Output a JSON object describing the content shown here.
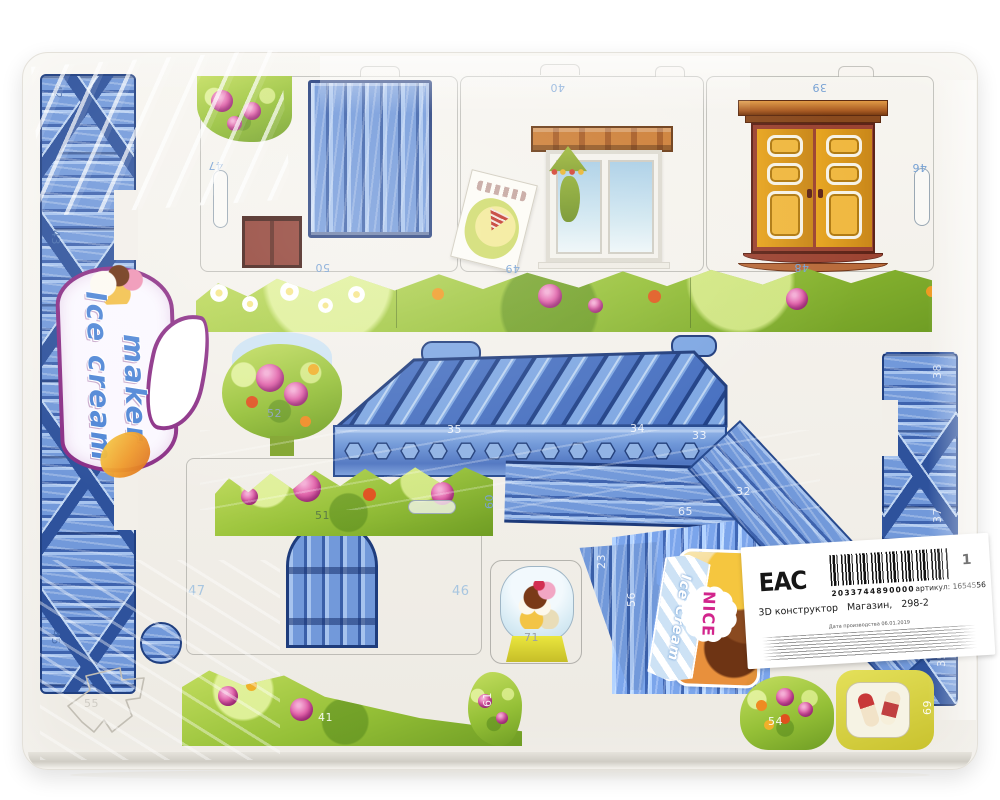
{
  "logo": {
    "line1": "Ice cream",
    "line2": "maker"
  },
  "sign": {
    "ribbon": "Ice Cream",
    "burst": "NICE"
  },
  "label": {
    "eac": "EAC",
    "qty": "1",
    "barcode": "2033744890000",
    "sku": "артикул: 1654556",
    "title": "3D конструктор   Магазин,   298-2",
    "date": "Дата производства 06.01.2019"
  },
  "piece_numbers": [
    "42",
    "43",
    "45",
    "47",
    "40",
    "39",
    "46",
    "48",
    "50",
    "49",
    "52",
    "35",
    "34",
    "33",
    "32",
    "65",
    "60",
    "51",
    "47",
    "46",
    "56",
    "23",
    "71",
    "41",
    "61",
    "54",
    "69",
    "38",
    "37",
    "35",
    "55"
  ]
}
